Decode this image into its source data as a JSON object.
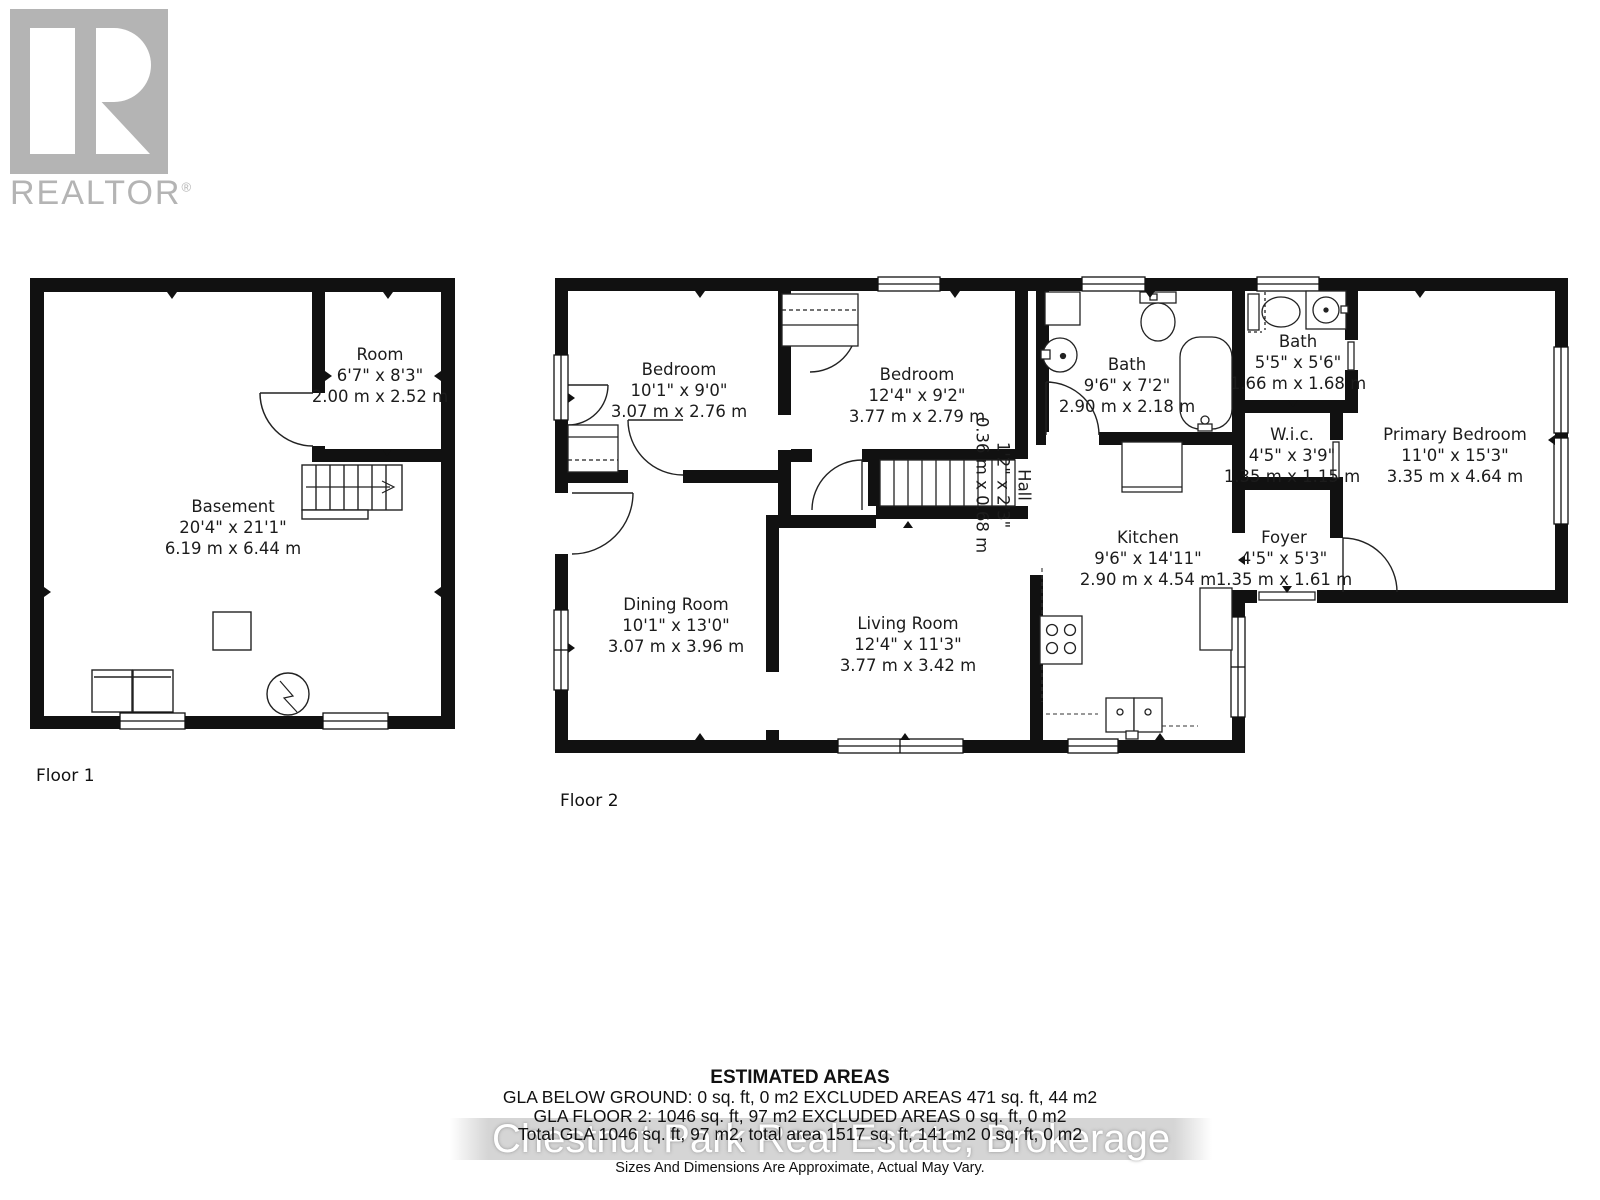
{
  "branding": {
    "logo_text": "REALTOR",
    "registered_mark": "®"
  },
  "colors": {
    "wall": "#111111",
    "logo_gray": "#b4b4b4",
    "label_text": "#1c1c1c",
    "watermark_band": "#c3c3c3",
    "watermark_text": "#ffffff"
  },
  "floor1": {
    "label": "Floor 1",
    "rooms": {
      "room": {
        "name": "Room",
        "imperial": "6'7\" x 8'3\"",
        "metric": "2.00 m x 2.52 m"
      },
      "basement": {
        "name": "Basement",
        "imperial": "20'4\" x 21'1\"",
        "metric": "6.19 m x 6.44 m"
      }
    }
  },
  "floor2": {
    "label": "Floor 2",
    "rooms": {
      "bedroom1": {
        "name": "Bedroom",
        "imperial": "10'1\" x 9'0\"",
        "metric": "3.07 m x 2.76 m"
      },
      "bedroom2": {
        "name": "Bedroom",
        "imperial": "12'4\" x 9'2\"",
        "metric": "3.77 m x 2.79 m"
      },
      "bath1": {
        "name": "Bath",
        "imperial": "9'6\" x 7'2\"",
        "metric": "2.90 m x 2.18 m"
      },
      "bath2": {
        "name": "Bath",
        "imperial": "5'5\" x 5'6\"",
        "metric": "1.66 m x 1.68 m"
      },
      "wic": {
        "name": "W.i.c.",
        "imperial": "4'5\" x 3'9\"",
        "metric": "1.35 m x 1.15 m"
      },
      "primary_bedroom": {
        "name": "Primary Bedroom",
        "imperial": "11'0\" x 15'3\"",
        "metric": "3.35 m x 4.64 m"
      },
      "foyer": {
        "name": "Foyer",
        "imperial": "4'5\" x 5'3\"",
        "metric": "1.35 m x 1.61 m"
      },
      "kitchen": {
        "name": "Kitchen",
        "imperial": "9'6\" x 14'11\"",
        "metric": "2.90 m x 4.54 m"
      },
      "dining": {
        "name": "Dining Room",
        "imperial": "10'1\" x 13'0\"",
        "metric": "3.07 m x 3.96 m"
      },
      "living": {
        "name": "Living Room",
        "imperial": "12'4\" x 11'3\"",
        "metric": "3.77 m x 3.42 m"
      },
      "hall": {
        "name": "Hall",
        "imperial": "1'2\" x 2'3\"",
        "metric": "0.36 m x 0.68 m"
      }
    }
  },
  "estimated_areas": {
    "title": "ESTIMATED AREAS",
    "lines": [
      "GLA BELOW GROUND: 0 sq. ft, 0 m2 EXCLUDED AREAS 471 sq. ft, 44 m2",
      "GLA FLOOR 2: 1046 sq. ft, 97 m2 EXCLUDED AREAS 0 sq. ft, 0 m2",
      "Total GLA 1046 sq. ft, 97 m2, total area 1517 sq. ft, 141 m2 0 sq. ft, 0 m2"
    ],
    "disclaimer": "Sizes And Dimensions Are Approximate, Actual May Vary."
  },
  "watermark": "Chestnut Park Real Estate, Brokerage"
}
